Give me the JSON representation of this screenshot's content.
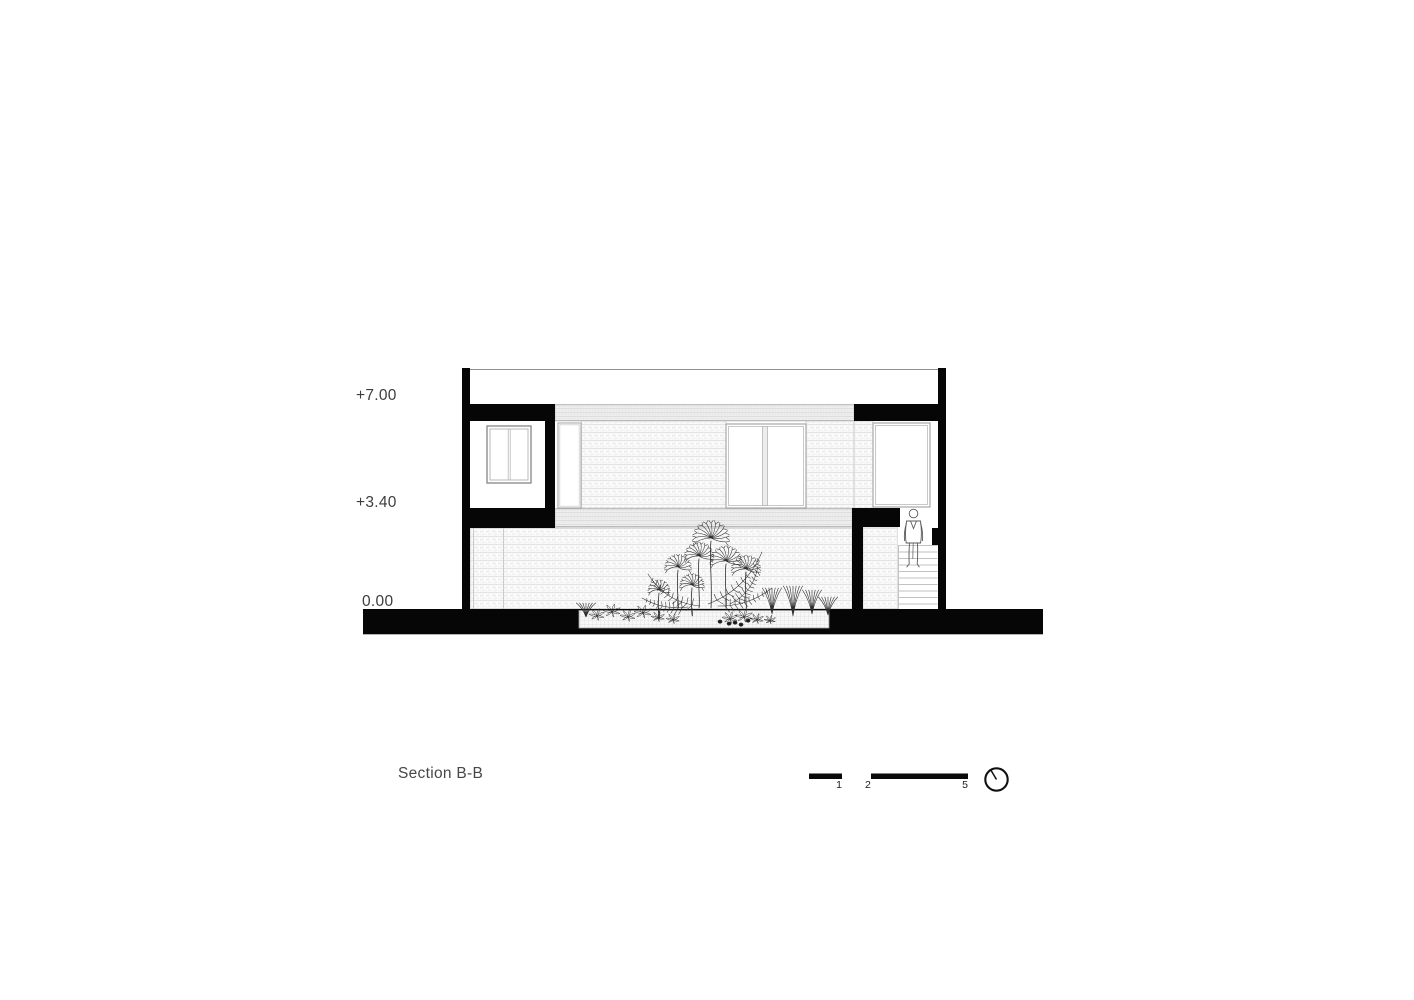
{
  "title": "Section B-B",
  "levels": {
    "roof": "+7.00",
    "first_floor": "+3.40",
    "ground": "0.00"
  },
  "scale_bar": {
    "tick1": "1",
    "tick2": "2",
    "tick5": "5"
  },
  "icons": {
    "north_indicator": "north-circle-icon"
  },
  "colors": {
    "ink": "#060606",
    "label": "#3d3d3d",
    "hatch_line": "#e3e3e3",
    "frame_gray": "#a8a8a8"
  }
}
